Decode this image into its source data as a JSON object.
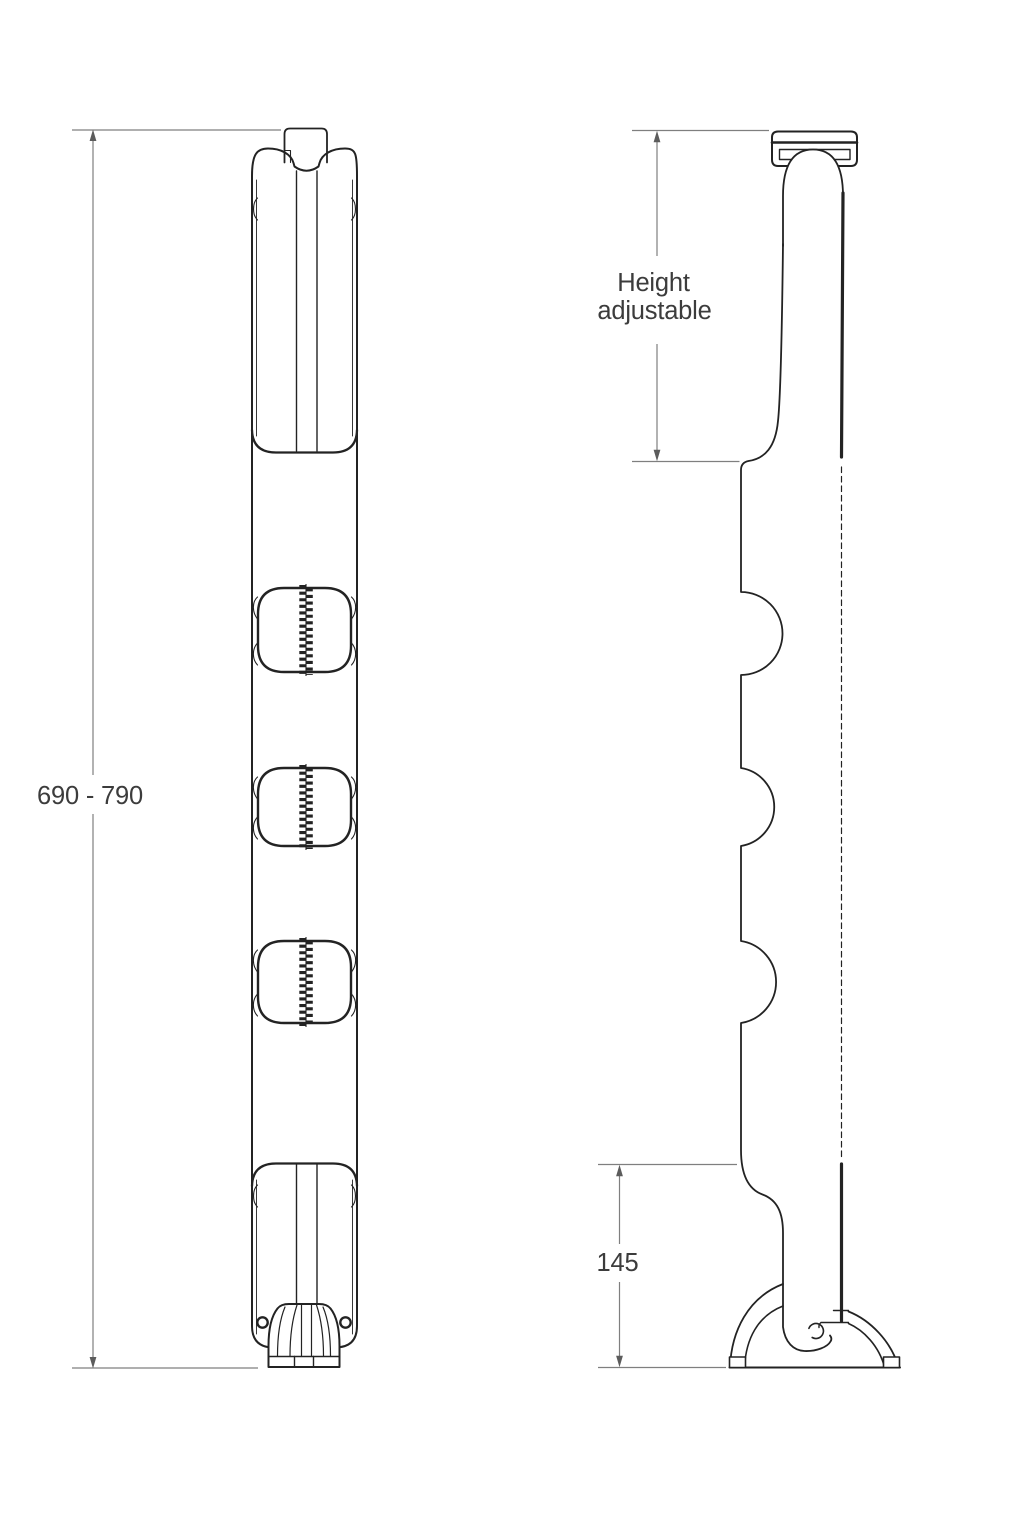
{
  "page": {
    "background": "#ffffff",
    "description": "Technical dimension line drawing, two orthographic views of a height-adjustable cable management spine with desk-edge bracket and weighted floor base"
  },
  "colors": {
    "outline": "#232323",
    "dimension_line": "#7f7f7f",
    "arrowhead": "#5c5c5c",
    "dimension_text": "#3c3c3c"
  },
  "views": {
    "front": {
      "name": "front view of cable spine"
    },
    "side": {
      "name": "side profile view of cable spine"
    }
  },
  "annotations": {
    "overall_height": "690 - 790",
    "height_adjustable_line1": "Height",
    "height_adjustable_line2": "adjustable",
    "base_height": "145"
  }
}
